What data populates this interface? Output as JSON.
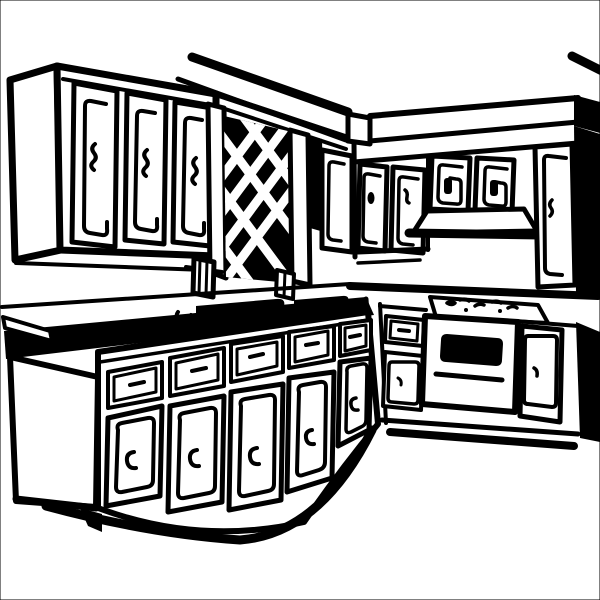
{
  "colors": {
    "ink": "#000000",
    "paper": "#ffffff"
  },
  "illustration": {
    "subject": "Black and white clip art line drawing of an L-shaped kitchen",
    "style": "hand-drawn marker / woodcut clip art, pure black ink on white",
    "elements": {
      "upper_cabinet_doors_left": 3,
      "upper_cabinet_doors_right": 5,
      "base_cabinet_units_left": 5,
      "features": [
        "diagonal ceiling lines",
        "lattice window with black opening",
        "window sill support brackets",
        "soffit band with black end cap",
        "range hood",
        "cooktop with scribbled burners",
        "oven with black window and handle bar",
        "double sink on countertop",
        "thick countertop edge band",
        "drawer and door base units with bracket handles",
        "toe kick shadow"
      ]
    }
  }
}
